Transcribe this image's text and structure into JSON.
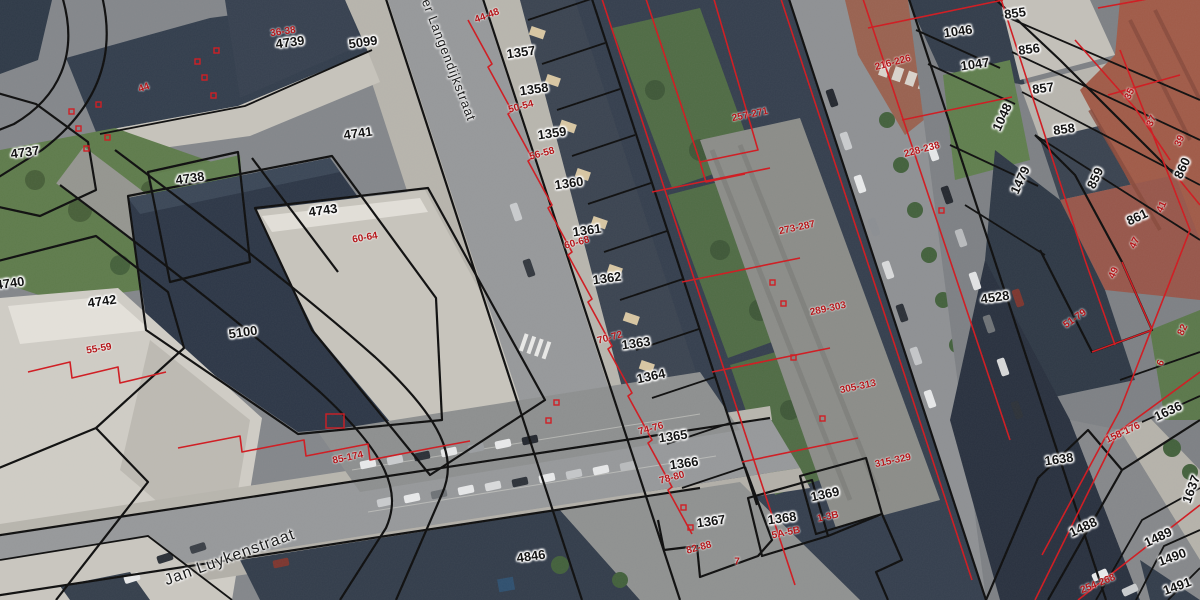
{
  "map": {
    "type": "cadastral-parcel-overlay-on-aerial-imagery",
    "colors": {
      "cadastral_line_black": "#0d0d0d",
      "cadastral_line_red": "#d0191f",
      "parcel_label_black": "#141414",
      "house_number_red": "#b5161a"
    },
    "labels": {
      "streets": [
        {
          "text": "er Langendijkstraat",
          "x": 449,
          "y": 60,
          "rot": 69,
          "size": 13
        },
        {
          "text": "Jan Luykenstraat",
          "x": 230,
          "y": 558,
          "rot": -20,
          "size": 16
        }
      ],
      "parcel_ids": [
        {
          "text": "5099",
          "x": 363,
          "y": 42,
          "rot": -8
        },
        {
          "text": "4739",
          "x": 290,
          "y": 42,
          "rot": -8
        },
        {
          "text": "4737",
          "x": 25,
          "y": 152,
          "rot": -8
        },
        {
          "text": "4738",
          "x": 190,
          "y": 178,
          "rot": -8
        },
        {
          "text": "4740",
          "x": 10,
          "y": 283,
          "rot": -8
        },
        {
          "text": "4741",
          "x": 358,
          "y": 133,
          "rot": -8
        },
        {
          "text": "4742",
          "x": 102,
          "y": 301,
          "rot": -8
        },
        {
          "text": "4743",
          "x": 323,
          "y": 210,
          "rot": -8
        },
        {
          "text": "5100",
          "x": 243,
          "y": 332,
          "rot": -8
        },
        {
          "text": "4846",
          "x": 531,
          "y": 556,
          "rot": -8
        },
        {
          "text": "4528",
          "x": 995,
          "y": 297,
          "rot": -8
        },
        {
          "text": "1357",
          "x": 521,
          "y": 52,
          "rot": -8
        },
        {
          "text": "1358",
          "x": 534,
          "y": 89,
          "rot": -8
        },
        {
          "text": "1359",
          "x": 552,
          "y": 133,
          "rot": -8
        },
        {
          "text": "1360",
          "x": 569,
          "y": 183,
          "rot": -8
        },
        {
          "text": "1361",
          "x": 587,
          "y": 230,
          "rot": -8
        },
        {
          "text": "1362",
          "x": 607,
          "y": 278,
          "rot": -8
        },
        {
          "text": "1363",
          "x": 636,
          "y": 343,
          "rot": -8
        },
        {
          "text": "1364",
          "x": 651,
          "y": 376,
          "rot": -12
        },
        {
          "text": "1365",
          "x": 673,
          "y": 436,
          "rot": -8
        },
        {
          "text": "1366",
          "x": 684,
          "y": 463,
          "rot": -8
        },
        {
          "text": "1367",
          "x": 711,
          "y": 521,
          "rot": -8
        },
        {
          "text": "1368",
          "x": 782,
          "y": 518,
          "rot": -8
        },
        {
          "text": "1369",
          "x": 825,
          "y": 494,
          "rot": -12
        },
        {
          "text": "855",
          "x": 1015,
          "y": 13,
          "rot": -8
        },
        {
          "text": "856",
          "x": 1029,
          "y": 49,
          "rot": -8
        },
        {
          "text": "857",
          "x": 1043,
          "y": 88,
          "rot": -8
        },
        {
          "text": "858",
          "x": 1064,
          "y": 129,
          "rot": -8
        },
        {
          "text": "859",
          "x": 1095,
          "y": 178,
          "rot": -65
        },
        {
          "text": "860",
          "x": 1182,
          "y": 168,
          "rot": -65
        },
        {
          "text": "861",
          "x": 1137,
          "y": 217,
          "rot": -25
        },
        {
          "text": "1046",
          "x": 958,
          "y": 31,
          "rot": -8
        },
        {
          "text": "1047",
          "x": 975,
          "y": 64,
          "rot": -8
        },
        {
          "text": "1048",
          "x": 1002,
          "y": 117,
          "rot": -65
        },
        {
          "text": "1479",
          "x": 1020,
          "y": 180,
          "rot": -65
        },
        {
          "text": "1636",
          "x": 1168,
          "y": 411,
          "rot": -25
        },
        {
          "text": "1637",
          "x": 1191,
          "y": 489,
          "rot": -70
        },
        {
          "text": "1638",
          "x": 1059,
          "y": 459,
          "rot": -8
        },
        {
          "text": "1488",
          "x": 1083,
          "y": 527,
          "rot": -25
        },
        {
          "text": "1489",
          "x": 1158,
          "y": 537,
          "rot": -25
        },
        {
          "text": "1490",
          "x": 1172,
          "y": 557,
          "rot": -20
        },
        {
          "text": "1491",
          "x": 1177,
          "y": 586,
          "rot": -20
        }
      ],
      "house_numbers": [
        {
          "text": "36-38",
          "x": 283,
          "y": 32,
          "rot": -8
        },
        {
          "text": "44",
          "x": 144,
          "y": 88,
          "rot": -20
        },
        {
          "text": "44-48",
          "x": 487,
          "y": 16,
          "rot": -20
        },
        {
          "text": "50-54",
          "x": 521,
          "y": 107,
          "rot": -15
        },
        {
          "text": "56-58",
          "x": 542,
          "y": 154,
          "rot": -15
        },
        {
          "text": "60-68",
          "x": 577,
          "y": 243,
          "rot": -15
        },
        {
          "text": "70-72",
          "x": 610,
          "y": 338,
          "rot": -15
        },
        {
          "text": "74-76",
          "x": 651,
          "y": 429,
          "rot": -15
        },
        {
          "text": "78-80",
          "x": 672,
          "y": 478,
          "rot": -15
        },
        {
          "text": "82-88",
          "x": 699,
          "y": 548,
          "rot": -15
        },
        {
          "text": "7",
          "x": 737,
          "y": 562,
          "rot": 0
        },
        {
          "text": "5A-5B",
          "x": 786,
          "y": 533,
          "rot": -12
        },
        {
          "text": "1-3B",
          "x": 828,
          "y": 517,
          "rot": -12
        },
        {
          "text": "55-59",
          "x": 99,
          "y": 349,
          "rot": -10
        },
        {
          "text": "60-64",
          "x": 365,
          "y": 238,
          "rot": -10
        },
        {
          "text": "85-174",
          "x": 348,
          "y": 458,
          "rot": -12
        },
        {
          "text": "257-271",
          "x": 750,
          "y": 115,
          "rot": -12
        },
        {
          "text": "273-287",
          "x": 797,
          "y": 228,
          "rot": -12
        },
        {
          "text": "289-303",
          "x": 828,
          "y": 309,
          "rot": -12
        },
        {
          "text": "305-313",
          "x": 858,
          "y": 387,
          "rot": -12
        },
        {
          "text": "315-329",
          "x": 893,
          "y": 461,
          "rot": -12
        },
        {
          "text": "216-226",
          "x": 893,
          "y": 63,
          "rot": -15
        },
        {
          "text": "228-238",
          "x": 922,
          "y": 150,
          "rot": -15
        },
        {
          "text": "51-79",
          "x": 1075,
          "y": 319,
          "rot": -35
        },
        {
          "text": "35",
          "x": 1130,
          "y": 94,
          "rot": -65
        },
        {
          "text": "37",
          "x": 1152,
          "y": 121,
          "rot": -65
        },
        {
          "text": "39",
          "x": 1180,
          "y": 141,
          "rot": -65
        },
        {
          "text": "41",
          "x": 1162,
          "y": 207,
          "rot": -65
        },
        {
          "text": "47",
          "x": 1135,
          "y": 243,
          "rot": -65
        },
        {
          "text": "49",
          "x": 1114,
          "y": 273,
          "rot": -65
        },
        {
          "text": "82",
          "x": 1183,
          "y": 330,
          "rot": -65
        },
        {
          "text": "6",
          "x": 1161,
          "y": 363,
          "rot": -65
        },
        {
          "text": "158-176",
          "x": 1123,
          "y": 433,
          "rot": -25
        },
        {
          "text": "254-268",
          "x": 1098,
          "y": 584,
          "rot": -22
        }
      ]
    }
  }
}
